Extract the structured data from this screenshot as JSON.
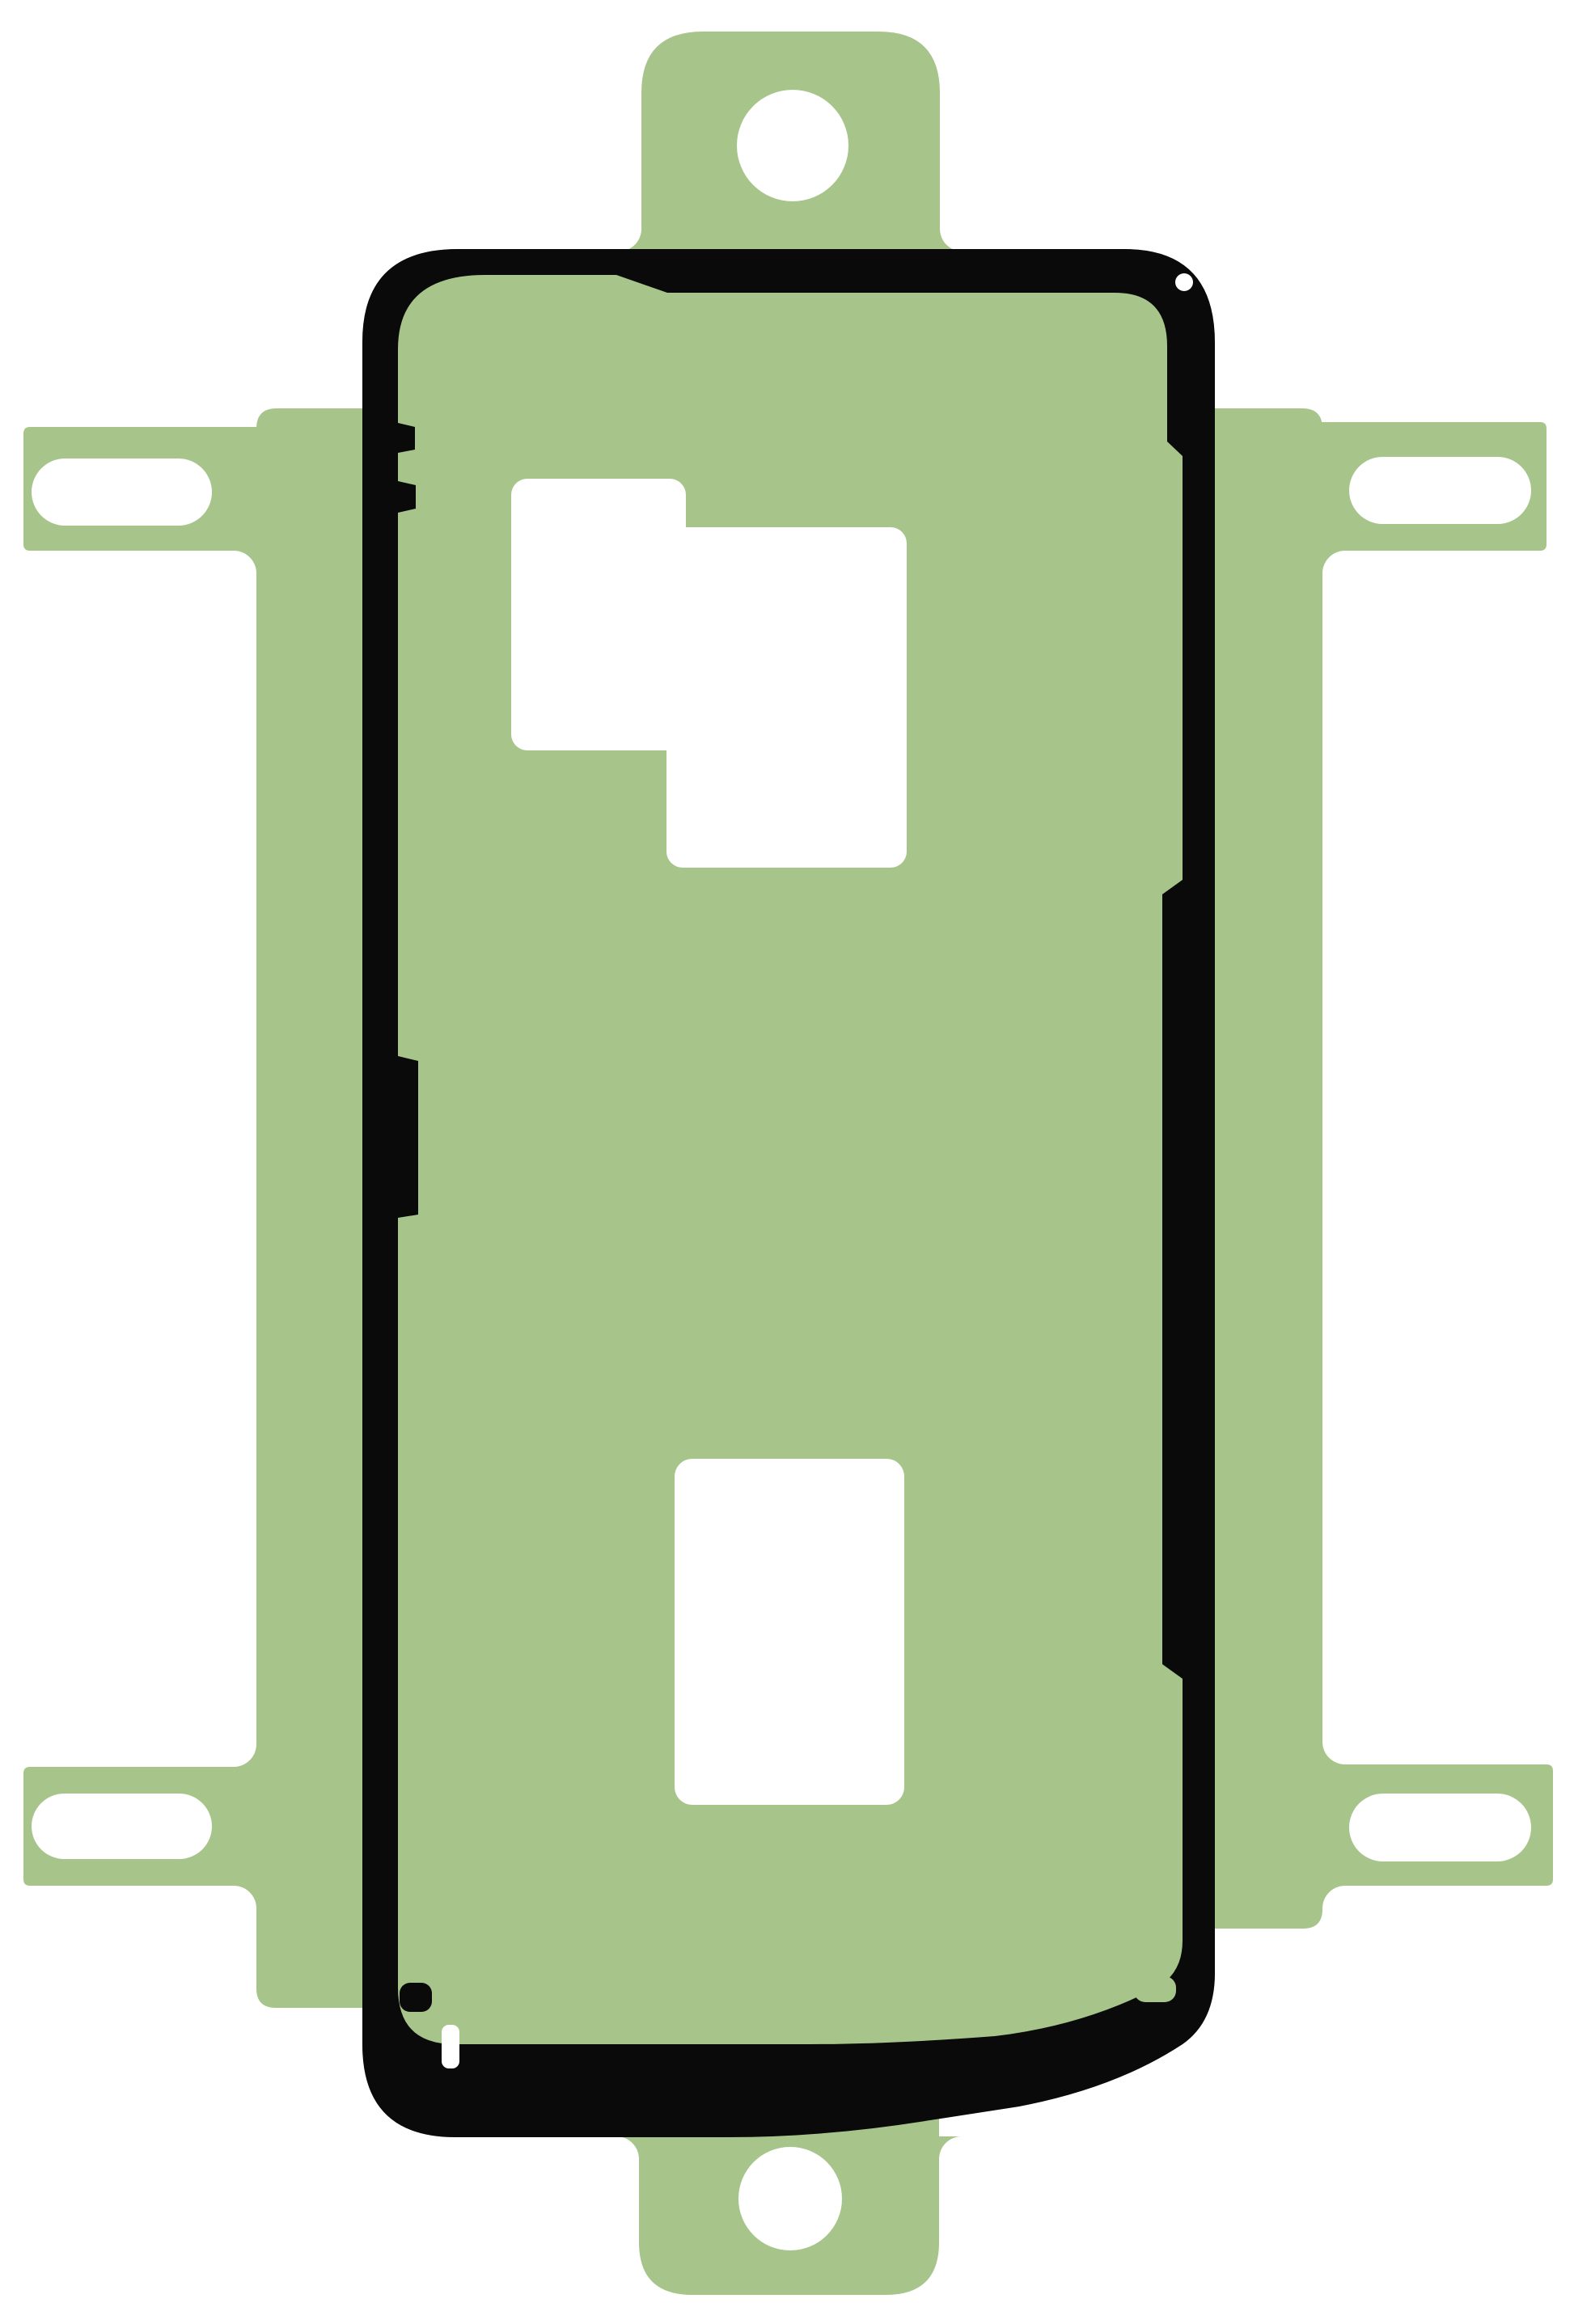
{
  "image": {
    "kind": "product-photo",
    "subject": "smartphone rear-cover adhesive sticker sheet with die-cut frame gasket",
    "orientation": "portrait"
  },
  "colors": {
    "background": "#ffffff",
    "sheet": "#a7c58a",
    "outline": "#0a0a0a",
    "cutout": "#ffffff"
  },
  "parts": {
    "sheet": "green liner sheet",
    "frame": "black adhesive frame outline",
    "top_tab": "top hanger tab with round hole",
    "bottom_tab": "bottom hanger tab with round hole",
    "left_arms": "left alignment arms with slotted holes",
    "right_arms": "right alignment arms with slotted holes",
    "camera_cutout": "camera window cutout",
    "lower_cutout": "lower rectangular window cutout"
  }
}
